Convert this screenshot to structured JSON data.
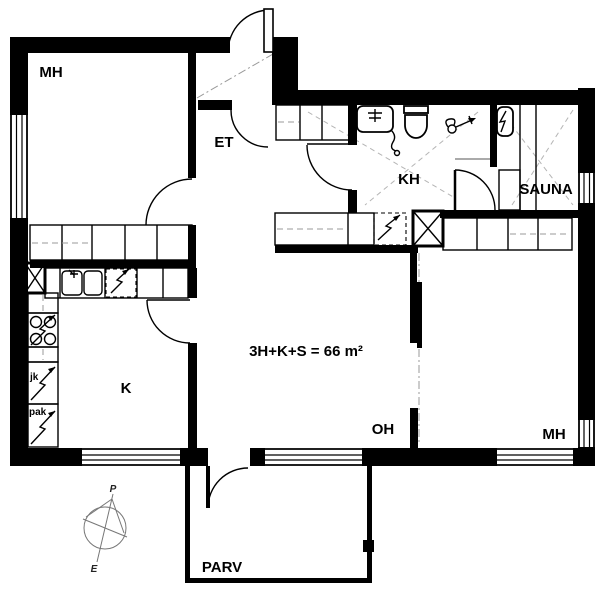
{
  "plan": {
    "area_label": "3H+K+S = 66 m²",
    "rooms": [
      {
        "id": "bedroom-nw",
        "label": "MH"
      },
      {
        "id": "entry-hall",
        "label": "ET"
      },
      {
        "id": "bathroom",
        "label": "KH"
      },
      {
        "id": "sauna",
        "label": "SAUNA"
      },
      {
        "id": "kitchen",
        "label": "K"
      },
      {
        "id": "living-room",
        "label": "OH"
      },
      {
        "id": "bedroom-e",
        "label": "MH"
      },
      {
        "id": "balcony",
        "label": "PARV"
      }
    ],
    "appliances": {
      "fridge": "jk",
      "freezer": "pak"
    },
    "compass": {
      "north": "P",
      "south": "E"
    },
    "colors": {
      "wall": "#000000",
      "background": "#ffffff",
      "dash": "#aaaaaa"
    }
  }
}
